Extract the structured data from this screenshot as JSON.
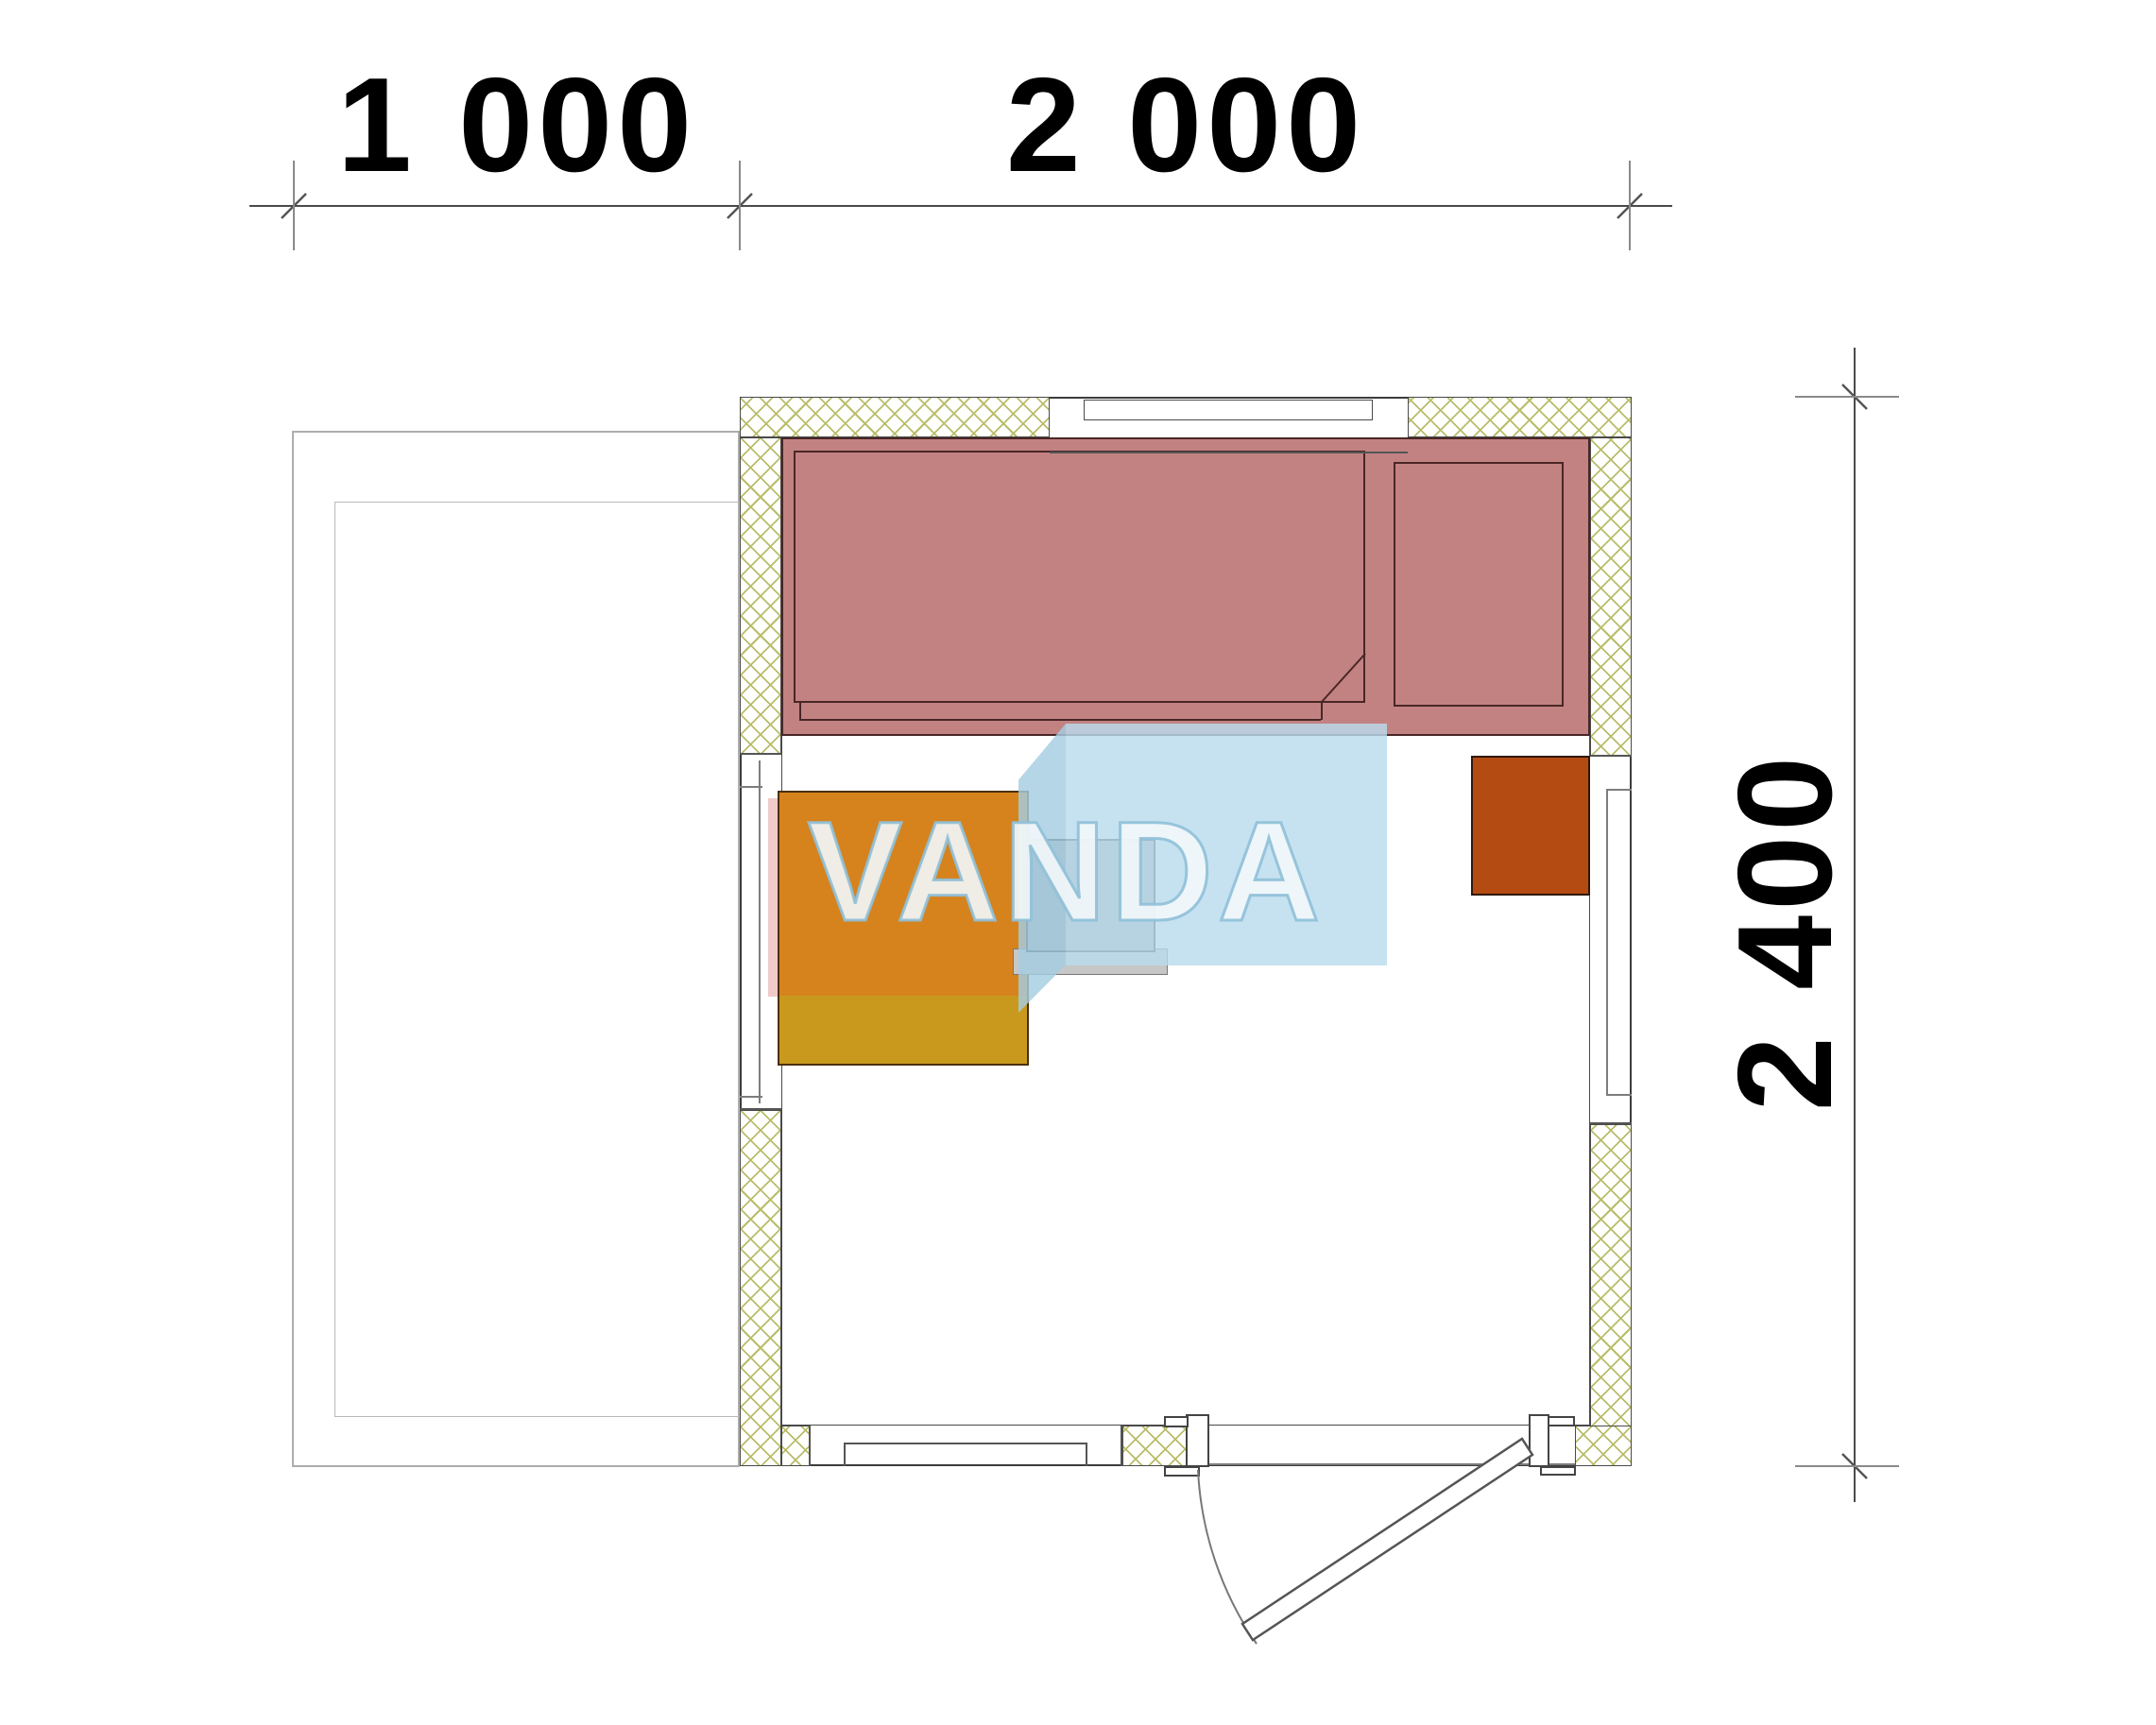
{
  "drawing": {
    "type_label": "floor-plan",
    "dimensions": {
      "top": [
        {
          "label": "1 000"
        },
        {
          "label": "2 000"
        }
      ],
      "side": {
        "label": "2 400"
      }
    },
    "watermark": {
      "text": "VANDA"
    }
  },
  "colors": {
    "bench_red": "#c28282",
    "table_orange": "#d6831e",
    "table_gold": "#c9991e",
    "shelf_brown": "#b34b12",
    "stove_gray": "#a9abad",
    "stove_light": "#c7c7c7",
    "wm_front": "#badcee",
    "wm_side": "#a5cde2",
    "hatch_line": "#b9bd6a",
    "pink_strip": "#f0caca"
  }
}
